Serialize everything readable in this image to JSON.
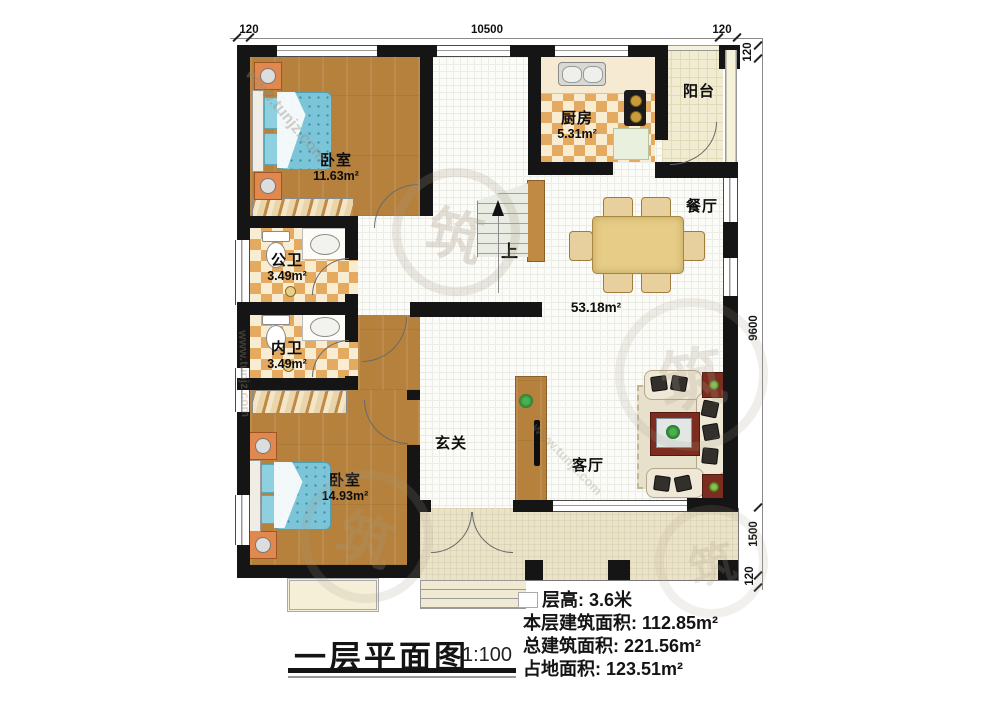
{
  "title": {
    "text": "一层平面图",
    "scale": "1:100"
  },
  "dimensions": {
    "top": [
      "120",
      "10500",
      "120"
    ],
    "right": [
      "120",
      "9600",
      "1500",
      "120"
    ]
  },
  "rooms": {
    "bedroom1": {
      "name": "卧室",
      "area": "11.63m²"
    },
    "bedroom2": {
      "name": "卧室",
      "area": "14.93m²"
    },
    "kitchen": {
      "name": "厨房",
      "area": "5.31m²"
    },
    "balcony": {
      "name": "阳台"
    },
    "dining": {
      "name": "餐厅"
    },
    "living": {
      "name": "客厅"
    },
    "foyer": {
      "name": "玄关"
    },
    "public_bath": {
      "name": "公卫",
      "area": "3.49m²"
    },
    "inner_bath": {
      "name": "内卫",
      "area": "3.49m²"
    },
    "hall": {
      "area": "53.18m²"
    },
    "stairs": {
      "up_label": "上"
    }
  },
  "info": {
    "lines": [
      "层高: 3.6米",
      "本层建筑面积: 112.85m²",
      "总建筑面积: 221.56m²",
      "占地面积: 123.51m²"
    ]
  },
  "watermark": {
    "url": "www.tunjz.com",
    "seal": "筑"
  },
  "colors": {
    "wall": "#151515",
    "wood_floor": "#b5813c",
    "checker_tile": "#e4aa60",
    "hall_tile": "#fbfbf8",
    "balcony_floor": "#f1ecd1",
    "porch_floor": "#ebe3c6",
    "bed_blue": "#7cc5d9",
    "table_tan": "#e6cc86",
    "rug_red": "#7c2d1f"
  }
}
